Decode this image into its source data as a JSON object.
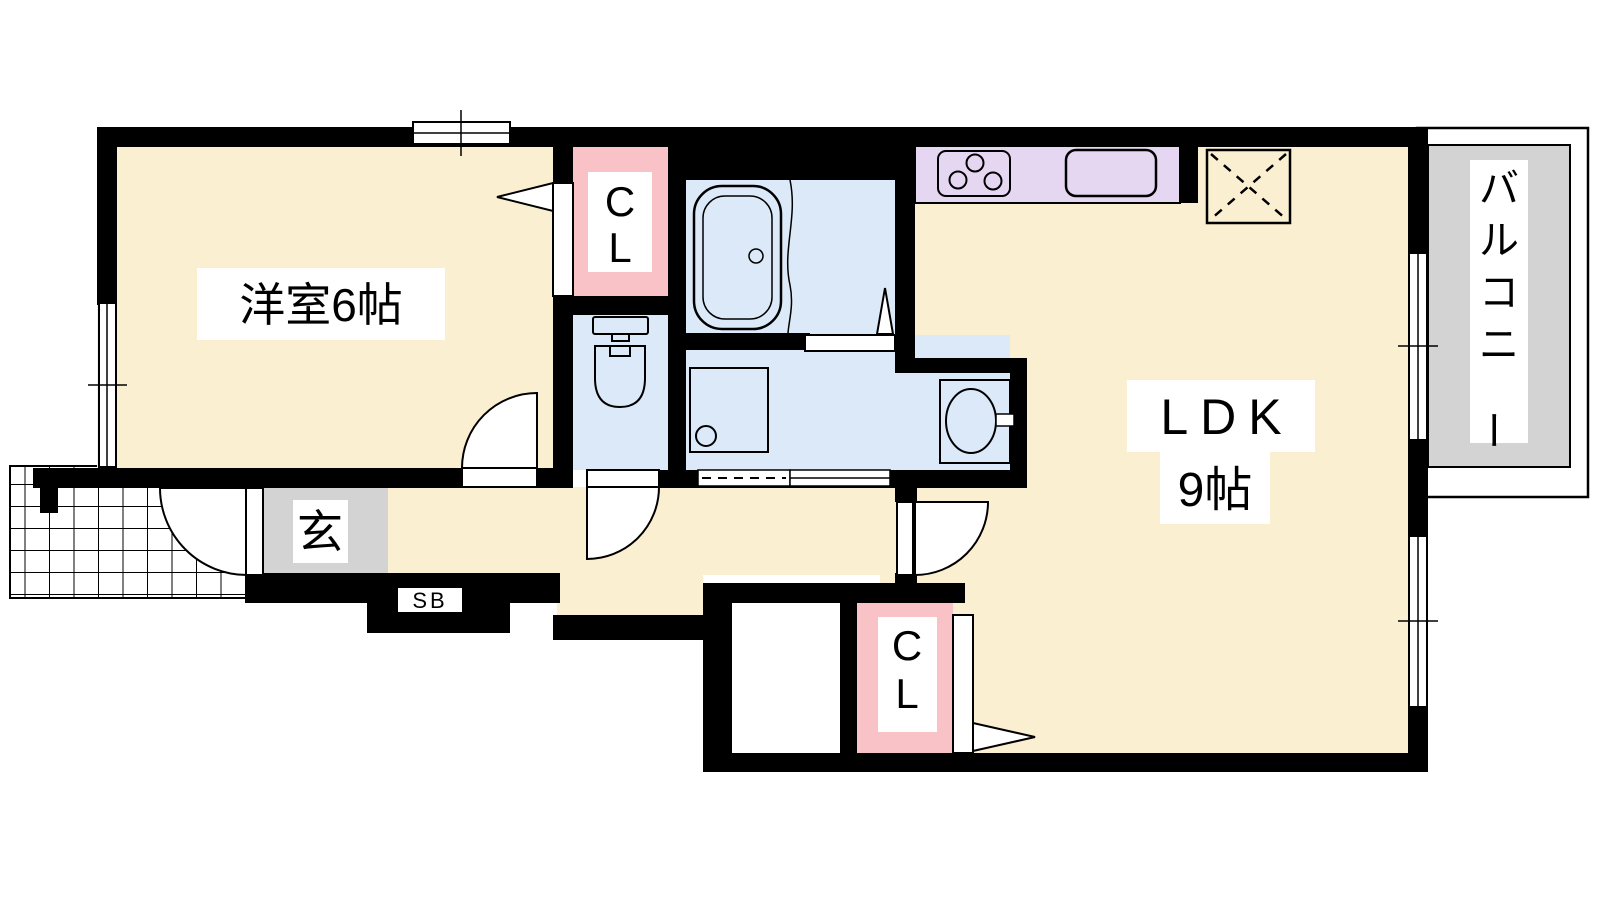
{
  "floorplan": {
    "rooms": {
      "western_room": {
        "label": "洋室6帖"
      },
      "ldk": {
        "label_line1": "LDK",
        "label_line2": "9帖"
      },
      "balcony": {
        "label": "バルコニー"
      },
      "entrance": {
        "label": "玄"
      },
      "shoe_box": {
        "label": "SB"
      },
      "closet_top": {
        "label": "CL"
      },
      "closet_bottom": {
        "label": "CL"
      }
    },
    "colors": {
      "room_floor_cream": "#FBEFD1",
      "closet_pink": "#F9C2C6",
      "wet_area_blue": "#DCE9F8",
      "kitchen_lavender": "#E5D7F1",
      "gray_area": "#D3D3D3",
      "wall_black": "#000000",
      "background": "#FFFFFF"
    }
  }
}
